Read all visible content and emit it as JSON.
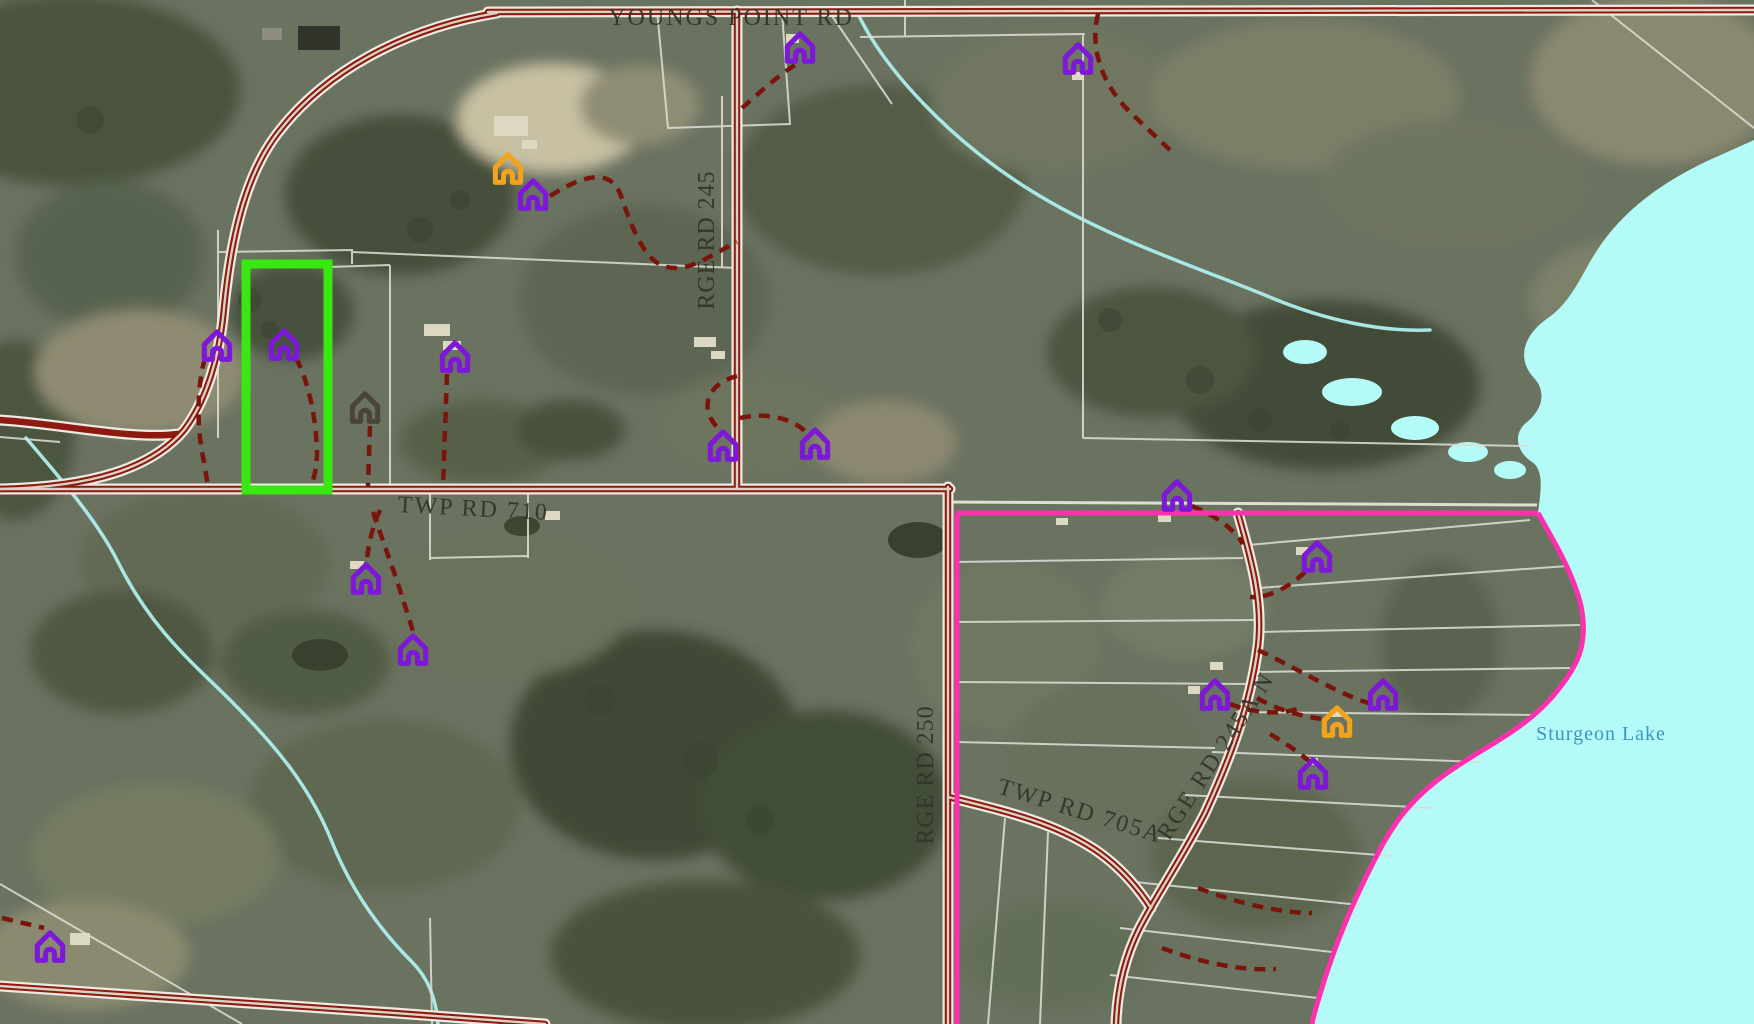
{
  "map": {
    "type": "aerial-parcel-map",
    "road_labels": [
      {
        "text": "YOUNGS POINT RD",
        "x": 731,
        "y": 25,
        "rotate": 0,
        "size": 24,
        "spacing": 2
      },
      {
        "text": "RGE RD 245",
        "x": 714,
        "y": 240,
        "rotate": -90,
        "size": 24,
        "spacing": 1
      },
      {
        "text": "TWP RD 710",
        "x": 473,
        "y": 516,
        "rotate": 3,
        "size": 24,
        "spacing": 2
      },
      {
        "text": "RGE RD 250",
        "x": 933,
        "y": 775,
        "rotate": -90,
        "size": 24,
        "spacing": 1
      },
      {
        "text": "TWP RD 705A",
        "x": 1078,
        "y": 818,
        "rotate": 17,
        "size": 24,
        "spacing": 2
      },
      {
        "text": "RGE RD 245A N",
        "x": 1222,
        "y": 760,
        "rotate": -57,
        "size": 24,
        "spacing": 2
      }
    ],
    "water_labels": [
      {
        "text": "Sturgeon Lake",
        "x": 1601,
        "y": 740,
        "rotate": 0,
        "size": 20,
        "spacing": 1
      }
    ],
    "markers": [
      {
        "x": 800,
        "y": 47,
        "color": "purple"
      },
      {
        "x": 1078,
        "y": 58,
        "color": "purple"
      },
      {
        "x": 533,
        "y": 194,
        "color": "purple"
      },
      {
        "x": 508,
        "y": 168,
        "color": "orange"
      },
      {
        "x": 217,
        "y": 345,
        "color": "purple"
      },
      {
        "x": 284,
        "y": 344,
        "color": "purple"
      },
      {
        "x": 455,
        "y": 356,
        "color": "purple"
      },
      {
        "x": 365,
        "y": 407,
        "color": "dark"
      },
      {
        "x": 723,
        "y": 445,
        "color": "purple"
      },
      {
        "x": 815,
        "y": 443,
        "color": "purple"
      },
      {
        "x": 366,
        "y": 578,
        "color": "purple"
      },
      {
        "x": 413,
        "y": 649,
        "color": "purple"
      },
      {
        "x": 50,
        "y": 946,
        "color": "purple"
      },
      {
        "x": 1177,
        "y": 495,
        "color": "purple"
      },
      {
        "x": 1317,
        "y": 556,
        "color": "purple"
      },
      {
        "x": 1215,
        "y": 694,
        "color": "purple"
      },
      {
        "x": 1383,
        "y": 694,
        "color": "purple"
      },
      {
        "x": 1337,
        "y": 721,
        "color": "orange"
      },
      {
        "x": 1313,
        "y": 773,
        "color": "purple"
      }
    ],
    "highlight": {
      "x": 246,
      "y": 264,
      "width": 82,
      "height": 226
    },
    "colors": {
      "land_base": "#6a7260",
      "road": "#8c1a10",
      "road_center": "#d8d2c2",
      "road_casing": "#eceae2",
      "driveway": "#7a150c",
      "parcel_line": "#dcdcd4",
      "boundary": "#ff30b0",
      "highlight": "#39e711",
      "lake": "#b4fbf8",
      "stream": "#aeeeec",
      "label": "#33332a",
      "water_label": "#3d95c2",
      "marker_purple": "#7d18d8",
      "marker_orange": "#f2a31d",
      "marker_dark": "#4b443b"
    }
  }
}
